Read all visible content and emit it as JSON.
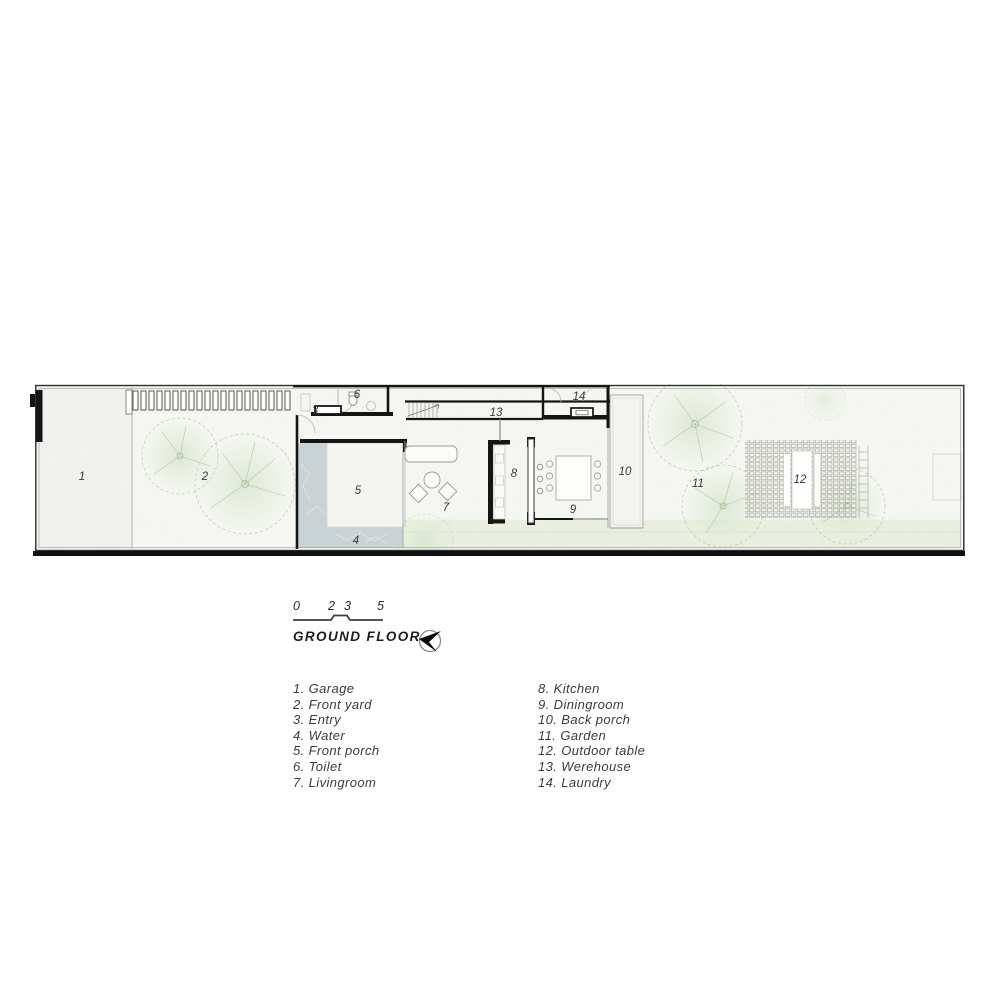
{
  "title": "GROUND FLOOR",
  "scale_bar": {
    "ticks": [
      "0",
      "2",
      "3",
      "5"
    ]
  },
  "compass": {
    "icon": "north-arrow"
  },
  "plan": {
    "labels": [
      "1",
      "2",
      "3",
      "4",
      "5",
      "6",
      "7",
      "8",
      "9",
      "10",
      "11",
      "12",
      "13",
      "14"
    ]
  },
  "legend": {
    "left": [
      "1. Garage",
      "2. Front yard",
      "3. Entry",
      "4. Water",
      "5. Front porch",
      "6. Toilet",
      "7. Livingroom"
    ],
    "right": [
      "8. Kitchen",
      "9. Diningroom",
      "10. Back porch",
      "11. Garden",
      "12. Outdoor table",
      "13. Werehouse",
      "14. Laundry"
    ]
  },
  "colors": {
    "wall": "#151515",
    "water": "#c9d3d5",
    "vegetation": "#8fae7e",
    "paper": "#f6f7f3",
    "grass": "#e9efe0",
    "text": "#3c3c3c"
  }
}
